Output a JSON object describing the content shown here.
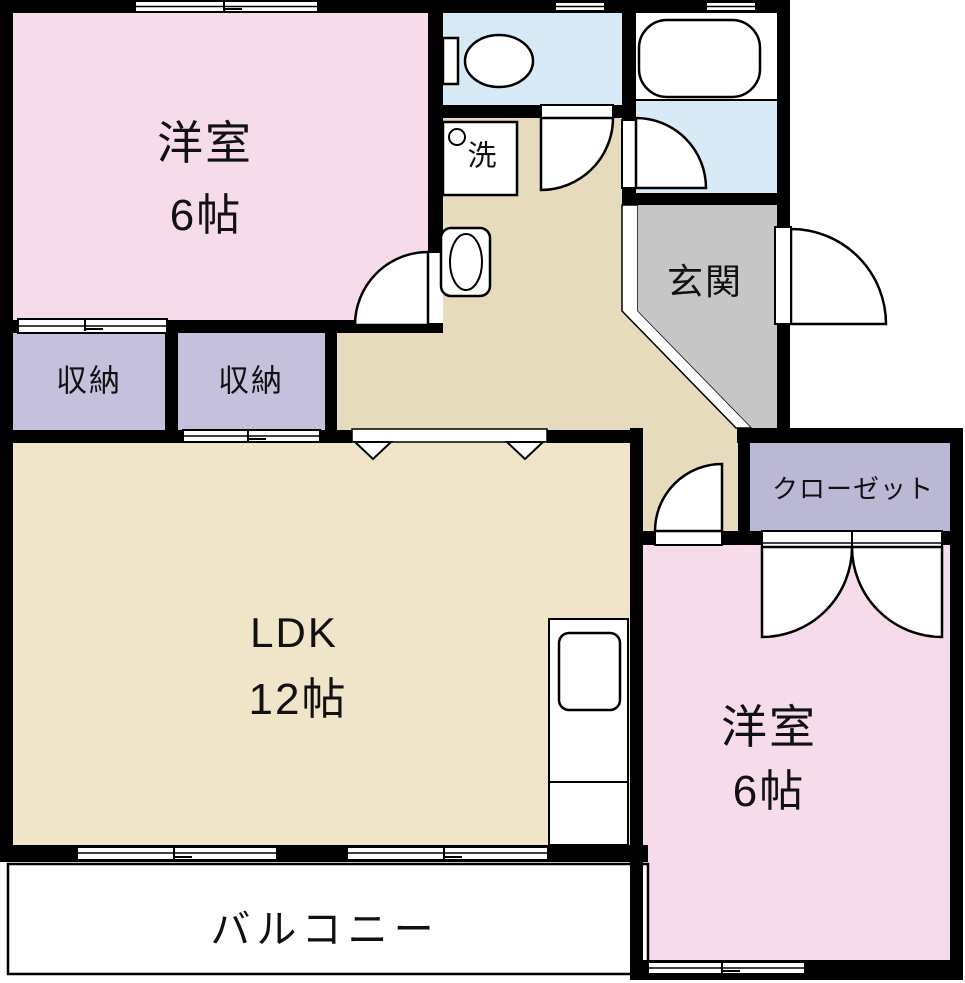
{
  "floorplan": {
    "type": "apartment-floor-plan",
    "bedroom1": {
      "name": "洋室",
      "size": "6帖"
    },
    "storage1": {
      "label": "収納"
    },
    "storage2": {
      "label": "収納"
    },
    "washroom": {
      "appliance_label": "洗"
    },
    "entrance": {
      "label": "玄関"
    },
    "closet": {
      "label": "クローゼット"
    },
    "ldk": {
      "name": "LDK",
      "size": "12帖"
    },
    "bedroom2": {
      "name": "洋室",
      "size": "6帖"
    },
    "balcony": {
      "label": "バルコニー"
    },
    "palette": {
      "wall": "#000000",
      "bedroom_pink": "#f6dbea",
      "storage_lavender": "#c5c1dd",
      "closet_lavender": "#bab8d5",
      "water_blue": "#d8eaf5",
      "hall_beige": "#e6dcbd",
      "ldk_cream": "#f1e5c9",
      "entrance_gray": "#c6c6c6",
      "fixture_white": "#ffffff"
    }
  }
}
